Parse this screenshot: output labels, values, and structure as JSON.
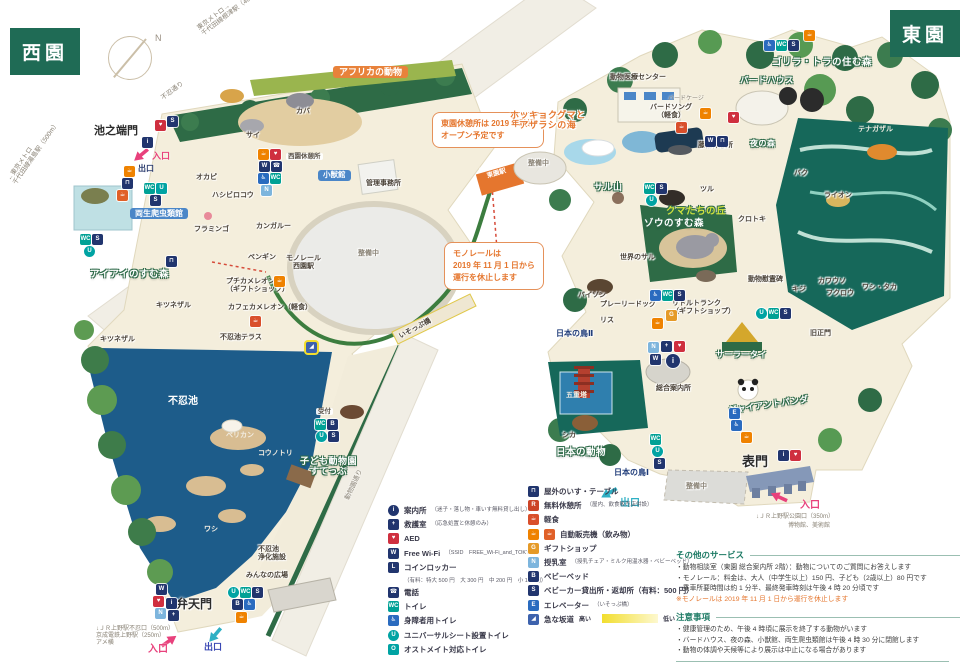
{
  "badges": {
    "west": "西園",
    "east": "東園"
  },
  "compass_n": "N",
  "roads": {
    "shinobazu": "不忍通り",
    "metro_nezu": "東京メトロ→\n千代田線根津駅（400m）",
    "metro_yushima": "←東京メトロ\n千代田線湯島駅（500m）",
    "zoo_street": "動物園通り"
  },
  "gates": {
    "ikenohata": "池之端門",
    "benten": "弁天門",
    "omote": "表門",
    "kyuseimon": "旧正門",
    "entrance": "入口",
    "exit": "出口",
    "benten_access": "↓ＪＲ上野駅不忍口（500m）\n京成電鉄上野駅（250m）\nアメ横",
    "omote_access1": "↓ＪＲ上野駅公園口（350m）",
    "omote_access2": "博物館、美術館"
  },
  "callouts": {
    "higashien_rest": "東園休憩所は 2019 年秋頃\nオープン予定です",
    "monorail_stop": "モノレールは\n2019 年 11 月 1 日から\n運行を休止します"
  },
  "monorail": {
    "west_station": "モノレール\n西園駅",
    "east_station": "モノレール\n東園駅"
  },
  "misc": {
    "seibi": "整備中",
    "pond": "不忍池",
    "reception": "受付",
    "isoppu": "いそっぷ橋"
  },
  "areas": {
    "africa": "アフリカの動物",
    "ayeaye": "アイアイのすむ森",
    "kids_zoo": "子ども動物園\nすてっぷ",
    "polar": "ホッキョクグマと\nアザラシの海",
    "gorilla_tiger": "ゴリラ・トラの住む森",
    "night_forest": "夜の森",
    "monkey_mountain": "サル山",
    "bear_hill": "クマたちの丘",
    "elephant_forest": "ゾウのすむ森",
    "japan_animals": "日本の動物",
    "japan_birds1": "日本の鳥Ⅰ",
    "japan_birds2": "日本の鳥Ⅱ",
    "giant_panda": "ジャイアントパンダ",
    "birdhouse": "バードハウス",
    "sala_thai": "サーラータイ"
  },
  "facilities": {
    "reptile_house": "両生爬虫類館",
    "small_mammal": "小獣館",
    "west_rest": "西園休憩所",
    "admin": "管理事務所",
    "medical": "動物医療センター",
    "bird_cage": "バードケージ",
    "bird_song": "バードソング\n（軽食）",
    "fujidana": "藤棚休憩所",
    "petit_chameleon": "プチカメレオン\n（ギフトショップ）",
    "cafe_chameleon": "カフェカメレオン（軽食）",
    "terrace": "不忍池テラス",
    "little_trunk": "リトルトランク\n（ギフトショップ）",
    "guide_center": "総合案内所",
    "pagoda": "五重塔",
    "memorial": "動物慰霊碑",
    "purification": "不忍池\n浄化施設",
    "minna_plaza": "みんなの広場"
  },
  "animals": {
    "hippo": "カバ",
    "rhino": "サイ",
    "okapi": "オカピ",
    "shoebill": "ハシビロコウ",
    "flamingo": "フラミンゴ",
    "kangaroo": "カンガルー",
    "penguin": "ペンギン",
    "lemur": "キツネザル",
    "pelican": "ペリカン",
    "stork": "コウノトリ",
    "eagle": "ワシ",
    "tenagazaru": "テナガザル",
    "tapir": "バク",
    "lion": "ライオン",
    "crane": "ツル",
    "kurotoki": "クロトキ",
    "world_monkey": "世界のサル",
    "bison": "バイソン",
    "prairie_dog": "プレーリードッグ",
    "squirrel": "リス",
    "pheasant": "キジ",
    "otter": "カワウソ",
    "owl": "フクロウ",
    "hawks": "ワシ・タカ",
    "deer": "シカ"
  },
  "icons": {
    "info": "i",
    "firstaid": "+",
    "aed": "♥",
    "wifi": "W",
    "locker": "L",
    "phone": "☎",
    "toilet": "WC",
    "accessible": "♿",
    "universal": "U",
    "ostomate": "O",
    "bench": "⊓",
    "resthouse": "R",
    "meal": "☕",
    "vending": "☕",
    "gift": "G",
    "nursing": "N",
    "babybed": "B",
    "stroller": "S",
    "elevator": "E",
    "slope": "◢"
  },
  "legend_left": [
    {
      "label": "案内所",
      "sub": "（迷子・落し物・車いす無料貸し出し）"
    },
    {
      "label": "救護室",
      "sub": "（応急処置と休憩のみ）"
    },
    {
      "label": "AED",
      "sub": ""
    },
    {
      "label": "Free Wi-Fi",
      "sub": "（SSID　FREE_Wi-Fi_and_TOKYO）"
    },
    {
      "label": "コインロッカー",
      "sub": "（有料：特大 500 円　大 300 円　中 200 円　小 100 円）"
    },
    {
      "label": "電話",
      "sub": ""
    },
    {
      "label": "トイレ",
      "sub": ""
    },
    {
      "label": "身障者用トイレ",
      "sub": ""
    },
    {
      "label": "ユニバーサルシート設置トイレ",
      "sub": ""
    },
    {
      "label": "オストメイト対応トイレ",
      "sub": ""
    }
  ],
  "legend_right": [
    {
      "label": "屋外のいす・テーブル",
      "sub": ""
    },
    {
      "label": "無料休憩所",
      "sub": "（屋内、飲食販売店併設）"
    },
    {
      "label": "軽食",
      "sub": ""
    },
    {
      "label": "自動販売機（飲み物）",
      "sub": ""
    },
    {
      "label": "ギフトショップ",
      "sub": ""
    },
    {
      "label": "授乳室",
      "sub": "（授乳チェア・ミルク用温水器・ベビーベッド）"
    },
    {
      "label": "ベビーベッド",
      "sub": ""
    },
    {
      "label": "ベビーカー貸出所・返却所（有料：500 円）",
      "sub": ""
    },
    {
      "label": "エレベーター",
      "sub": "（いそっぷ橋）"
    },
    {
      "label": "急な坂道",
      "sub": ""
    }
  ],
  "slope": {
    "high": "高い",
    "low": "低い"
  },
  "services": {
    "title": "その他のサービス",
    "items": [
      "・動物相談室（東園 総合案内所 2階）：動物についてのご質問にお答えします",
      "・モノレール：料金は、大人（中学生以上）150 円、子ども（2歳以上）80 円です",
      "　乗車所要時間は約 1 分半、最終発車時刻は午後 4 時 20 分頃です"
    ],
    "note": "※モノレールは 2019 年 11 月 1 日から運行を休止します"
  },
  "cautions": {
    "title": "注意事項",
    "items": [
      "・健康管理のため、午後 4 時頃に展示を終了する動物がいます",
      "・バードハウス、夜の森、小獣館、両生爬虫類館は午後 4 時 30 分に閉館します",
      "・動物の体調や天候等により展示は中止になる場合があります"
    ]
  }
}
